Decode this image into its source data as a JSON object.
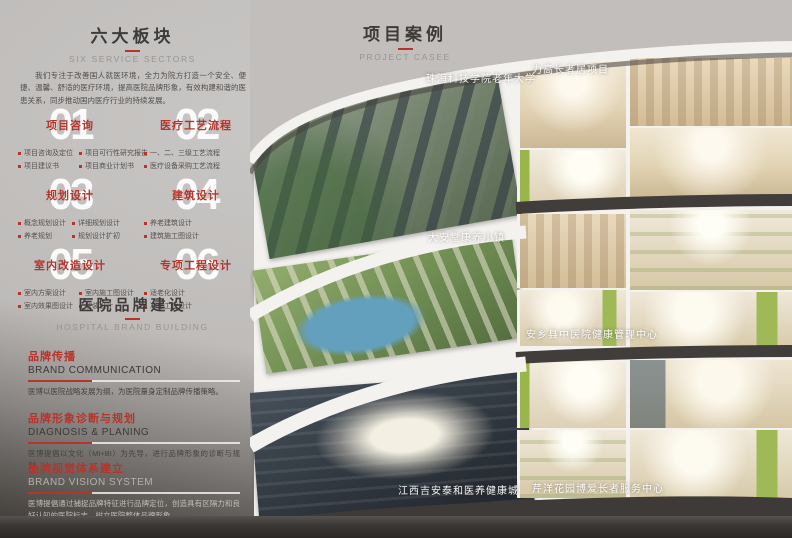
{
  "colors": {
    "accent_red": "#b5342c",
    "page_gray": "#bcb9b7",
    "dark_band": "#3e3a37",
    "collage_white": "#f4f2ef"
  },
  "left": {
    "title": "六大板块",
    "subtitle": "SIX SERVICE SECTORS",
    "intro": "我们专注于改善国人就医环境，全力为院方打造一个安全、便捷、温馨、舒适的医疗环境，提高医院品牌形象，有效构建和谐的医患关系，同步推动国内医疗行业的持续发展。",
    "sectors": [
      {
        "num": "01",
        "title": "项目咨询",
        "items": [
          "项目咨询及定位",
          "项目可行性研究报告",
          "项目建议书",
          "项目商业计划书"
        ]
      },
      {
        "num": "02",
        "title": "医疗工艺流程",
        "items": [
          "一、二、三级工艺流程",
          "医疗设备采购工艺流程"
        ]
      },
      {
        "num": "03",
        "title": "规划设计",
        "items": [
          "概念规划设计",
          "详细规划设计",
          "养老规划",
          "规划设计扩初"
        ]
      },
      {
        "num": "04",
        "title": "建筑设计",
        "items": [
          "养老建筑设计",
          "建筑施工图设计"
        ]
      },
      {
        "num": "05",
        "title": "室内改造设计",
        "items": [
          "室内方案设计",
          "室内施工图设计",
          "室内效果图设计",
          "软装设计"
        ]
      },
      {
        "num": "06",
        "title": "专项工程设计",
        "items": [
          "适老化设计",
          "净化工程设计"
        ]
      }
    ],
    "brand": {
      "title": "医院品牌建设",
      "subtitle": "HOSPITAL BRAND BUILDING",
      "sections": [
        {
          "cn": "品牌传播",
          "en": "BRAND COMMUNICATION",
          "body": "医博以医院战略发展为纲，为医院量身定制品牌传播策略。"
        },
        {
          "cn": "品牌形象诊断与规划",
          "en": "DIAGNOSIS & PLANING",
          "body": "医博提倡以文化（MI+BI）为先导，进行品牌形象的诊断与规划。"
        },
        {
          "cn": "品牌视觉体系建立",
          "en": "BRAND VISION SYSTEM",
          "body": "医博提倡通过捕捉品牌特征进行品牌定位，创造具有区隔力和良好认知的医院标志，树立医院整体品牌形象。"
        }
      ]
    }
  },
  "right": {
    "title": "项目案例",
    "subtitle": "PROJECT CASEE",
    "captions": [
      "珠海科技学院老年大学",
      "力高长者居项目",
      "大安堂康养小镇",
      "安乡县中医院健康管理中心",
      "江西吉安泰和医养健康城",
      "芹洋花园博爱长者服务中心"
    ]
  }
}
